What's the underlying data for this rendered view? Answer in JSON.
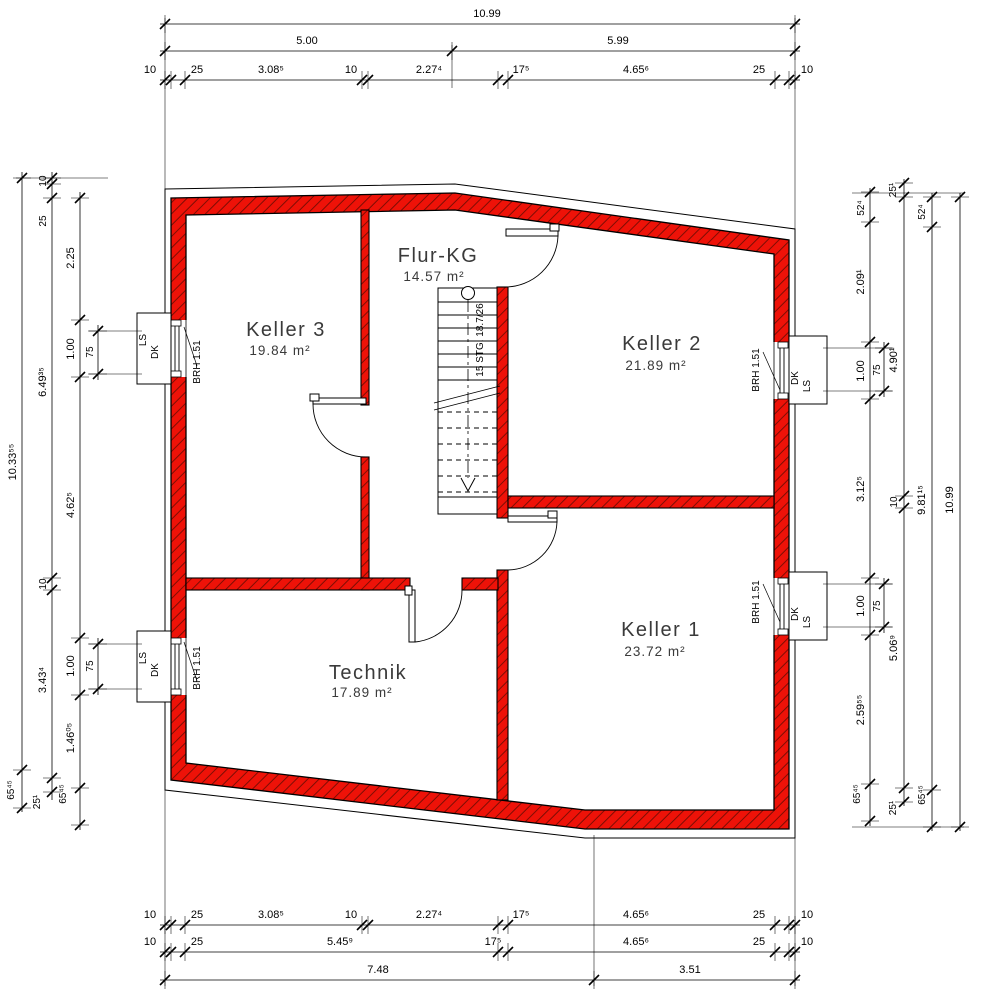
{
  "drawing": {
    "title": "Kellergeschoss Grundriss",
    "rooms": [
      {
        "name": "Keller 3",
        "area": "19.84 m²"
      },
      {
        "name": "Flur-KG",
        "area": "14.57 m²"
      },
      {
        "name": "Keller 2",
        "area": "21.89 m²"
      },
      {
        "name": "Keller 1",
        "area": "23.72 m²"
      },
      {
        "name": "Technik",
        "area": "17.89 m²"
      }
    ],
    "stairs": {
      "label": "15 STG. 18.7/26"
    },
    "windows": {
      "parapet_label": "BRH 1.51",
      "lightwell_labels": [
        "LS",
        "DK"
      ]
    },
    "dimensions": {
      "top": [
        [
          "10.99"
        ],
        [
          "5.00",
          "5.99"
        ],
        [
          "10",
          "25",
          "3.08⁵",
          "10",
          "2.27⁴",
          "17⁵",
          "4.65⁶",
          "25",
          "10"
        ]
      ],
      "bottom": [
        [
          "10",
          "25",
          "3.08⁵",
          "10",
          "2.27⁴",
          "17⁵",
          "4.65⁶",
          "25",
          "10"
        ],
        [
          "10",
          "25",
          "5.45⁹",
          "17⁵",
          "4.65⁶",
          "25",
          "10"
        ],
        [
          "7.48",
          "3.51"
        ]
      ],
      "left": [
        [
          "10.33⁵⁵",
          "65⁴⁵"
        ],
        [
          "10",
          "25",
          "6.49³⁵",
          "10",
          "3.43⁴",
          "25¹"
        ],
        [
          "2.25",
          "1.00",
          "4.62⁵",
          "1.00",
          "1.46⁰⁵",
          "65⁴⁵"
        ],
        [
          "75",
          "75"
        ]
      ],
      "right": [
        [
          "52⁴",
          "2.09¹",
          "1.00",
          "3.12⁵",
          "1.00",
          "2.59⁵⁵",
          "65⁴⁵"
        ],
        [
          "75",
          "75"
        ],
        [
          "25¹",
          "4.90¹",
          "10",
          "5.06⁹",
          "25¹"
        ],
        [
          "52⁴",
          "9.81¹⁵",
          "65⁴⁵"
        ],
        [
          "10.99"
        ]
      ]
    },
    "colors": {
      "wall": "#ee1208",
      "hatch": "#7e0d04",
      "line": "#000000"
    }
  }
}
